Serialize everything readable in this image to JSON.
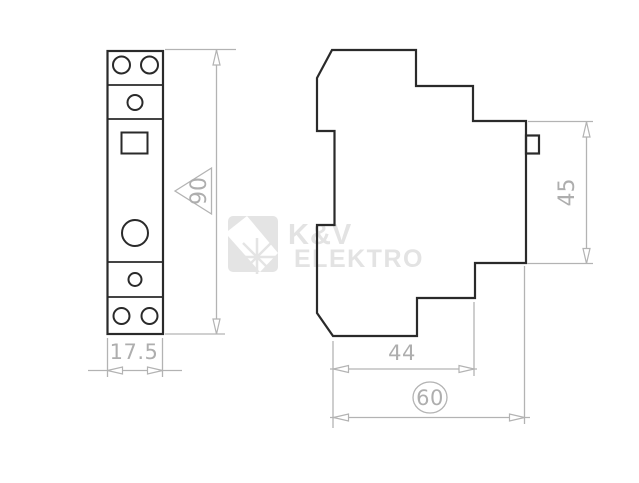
{
  "page": {
    "kind": "product-dimension-drawing",
    "background": "#ffffff"
  },
  "watermark": {
    "line1": "K&V",
    "line2": "ELEKTRO",
    "color": "#e3e3e3"
  },
  "views": {
    "front": {
      "label": "front-view-of-din-module"
    },
    "side": {
      "label": "side-profile-view-of-din-module"
    }
  },
  "dimensions": {
    "front_width": "17.5",
    "front_height": "90",
    "side_height": "45",
    "side_depth": "44",
    "side_total_depth": "60"
  },
  "colors": {
    "outline": "#2a2a2a",
    "dimension": "#b3b3b3",
    "dimension_text": "#aeaeae",
    "watermark": "#e3e3e3"
  }
}
